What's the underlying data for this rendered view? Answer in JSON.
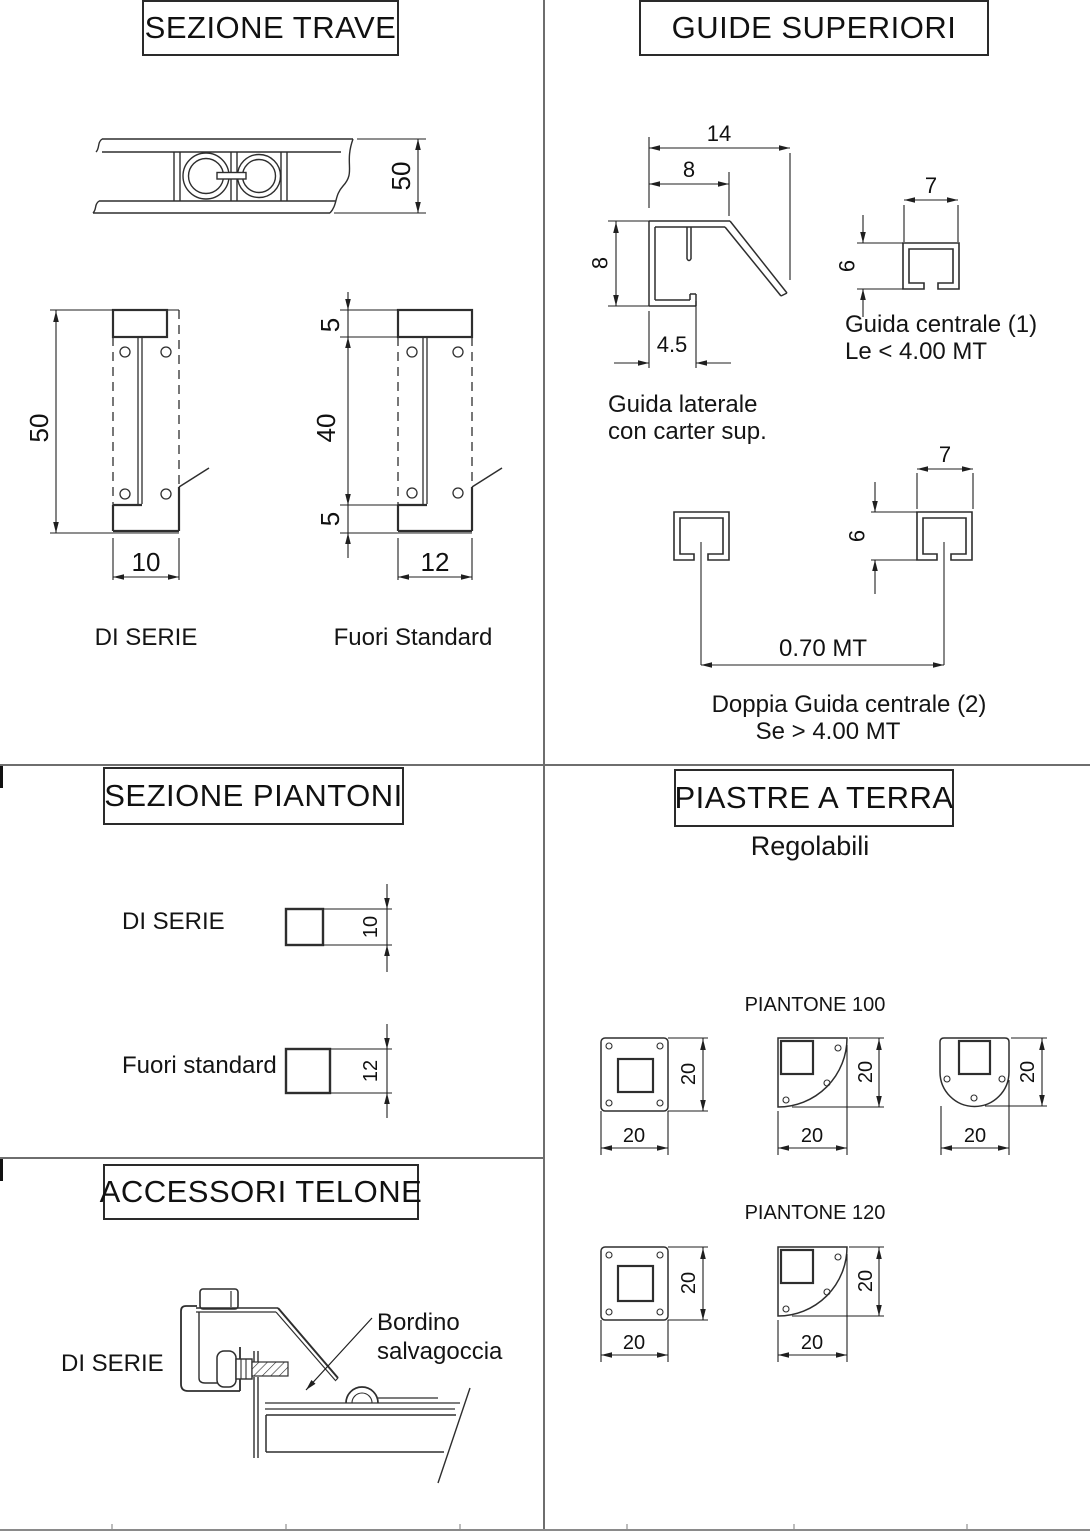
{
  "sezione_trave": {
    "title": "SEZIONE TRAVE",
    "beam_dim_height": "50",
    "di_serie": {
      "label": "DI SERIE",
      "dim_height": "50",
      "dim_width": "10"
    },
    "fuori_standard": {
      "label": "Fuori Standard",
      "dim_top": "5",
      "dim_mid": "40",
      "dim_bot": "5",
      "dim_width": "12"
    }
  },
  "guide_superiori": {
    "title": "GUIDE SUPERIORI",
    "guida_laterale": {
      "caption_1": "Guida laterale",
      "caption_2": "con carter sup.",
      "dim_w_tot": "14",
      "dim_w_top": "8",
      "dim_h": "8",
      "dim_w_bot": "4.5"
    },
    "guida_centrale": {
      "caption_1": "Guida centrale (1)",
      "caption_2": "Le < 4.00 MT",
      "dim_w": "7",
      "dim_h": "6"
    },
    "doppia_guida": {
      "caption_1": "Doppia Guida centrale (2)",
      "caption_2": "Se > 4.00 MT",
      "dim_w": "7",
      "dim_h": "6",
      "dim_span": "0.70 MT"
    }
  },
  "sezione_piantoni": {
    "title": "SEZIONE PIANTONI",
    "di_serie": {
      "label": "DI SERIE",
      "dim": "10"
    },
    "fuori_standard": {
      "label": "Fuori standard",
      "dim": "12"
    }
  },
  "piastre_a_terra": {
    "title": "PIASTRE A TERRA",
    "subtitle": "Regolabili",
    "piantone_100": {
      "label": "PIANTONE 100",
      "plates": [
        {
          "w": "20",
          "h": "20"
        },
        {
          "w": "20",
          "h": "20"
        },
        {
          "w": "20",
          "h": "20"
        }
      ]
    },
    "piantone_120": {
      "label": "PIANTONE 120",
      "plates": [
        {
          "w": "20",
          "h": "20"
        },
        {
          "w": "20",
          "h": "20"
        }
      ]
    }
  },
  "accessori_telone": {
    "title": "ACCESSORI TELONE",
    "label": "DI SERIE",
    "callout_1": "Bordino",
    "callout_2": "salvagoccia"
  }
}
